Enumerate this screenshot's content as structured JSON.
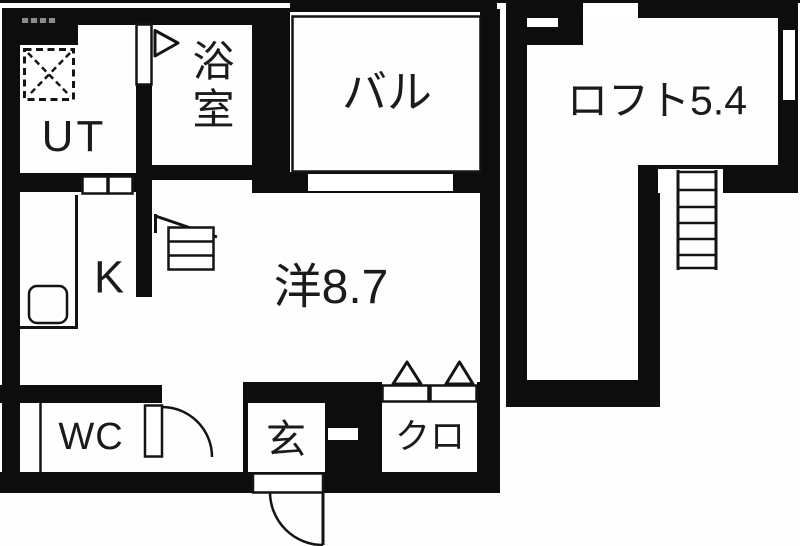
{
  "title": "apartment floor plan",
  "colors": {
    "wall": "#0d0d0d",
    "background": "#ffffff",
    "text": "#1b1b1b"
  },
  "rooms": {
    "ut": {
      "label": "UT"
    },
    "bathroom": {
      "label": "浴室"
    },
    "balcony": {
      "label": "バル"
    },
    "loft": {
      "label": "ロフト5.4"
    },
    "kitchen": {
      "label": "K"
    },
    "western_room": {
      "label": "洋8.7"
    },
    "wc": {
      "label": "WC"
    },
    "entrance": {
      "label": "玄"
    },
    "closet": {
      "label": "クロ"
    }
  },
  "symbols": [
    "washing-machine-pan",
    "bathroom-door-triangle",
    "kitchen-sink-counter",
    "stepladder-to-loft",
    "loft-ladder",
    "wc-swing-door",
    "entrance-swing-door",
    "closet-folding-doors",
    "balcony-railing",
    "windows"
  ]
}
